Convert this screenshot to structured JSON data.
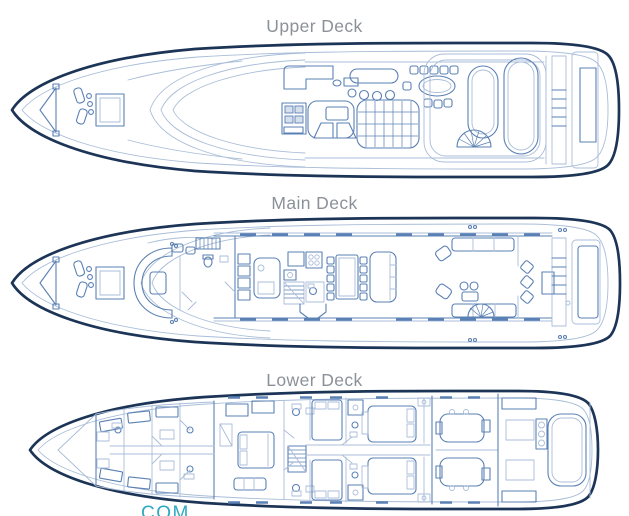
{
  "page": {
    "watermark": "COM"
  },
  "colors": {
    "hull": "#1c3456",
    "line_mid": "#5b80b4",
    "line_light": "#a9bdd8",
    "label": "#8b9199",
    "watermark": "#2fa9c0"
  },
  "decks": [
    {
      "id": "upper",
      "label": "Upper Deck"
    },
    {
      "id": "main",
      "label": "Main Deck"
    },
    {
      "id": "lower",
      "label": "Lower Deck"
    }
  ]
}
